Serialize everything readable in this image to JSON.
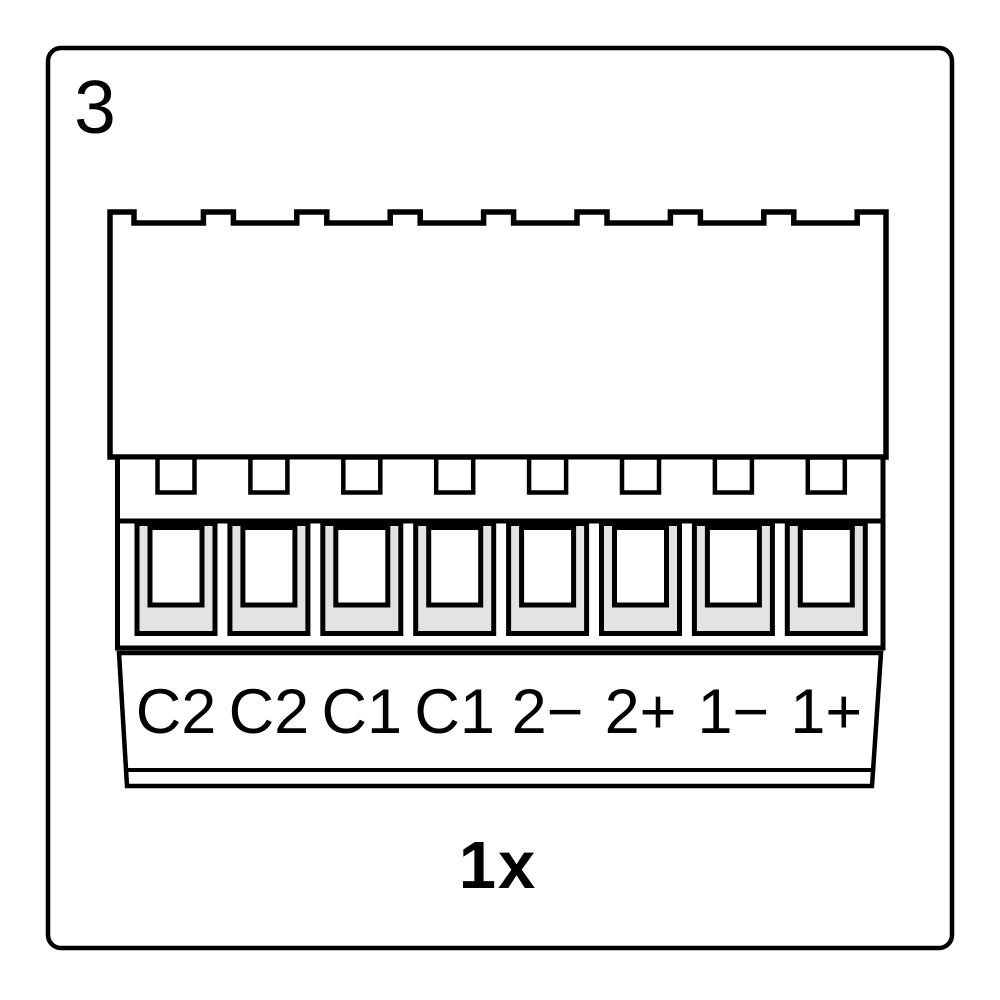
{
  "step_number": "3",
  "quantity_label": "1x",
  "connector": {
    "pin_count": 8,
    "pin_labels": [
      "C2",
      "C2",
      "C1",
      "C1",
      "2−",
      "2+",
      "1−",
      "1+"
    ],
    "colors": {
      "outline": "#000000",
      "terminal_fill": "#e3e3e3",
      "background": "#ffffff"
    }
  }
}
